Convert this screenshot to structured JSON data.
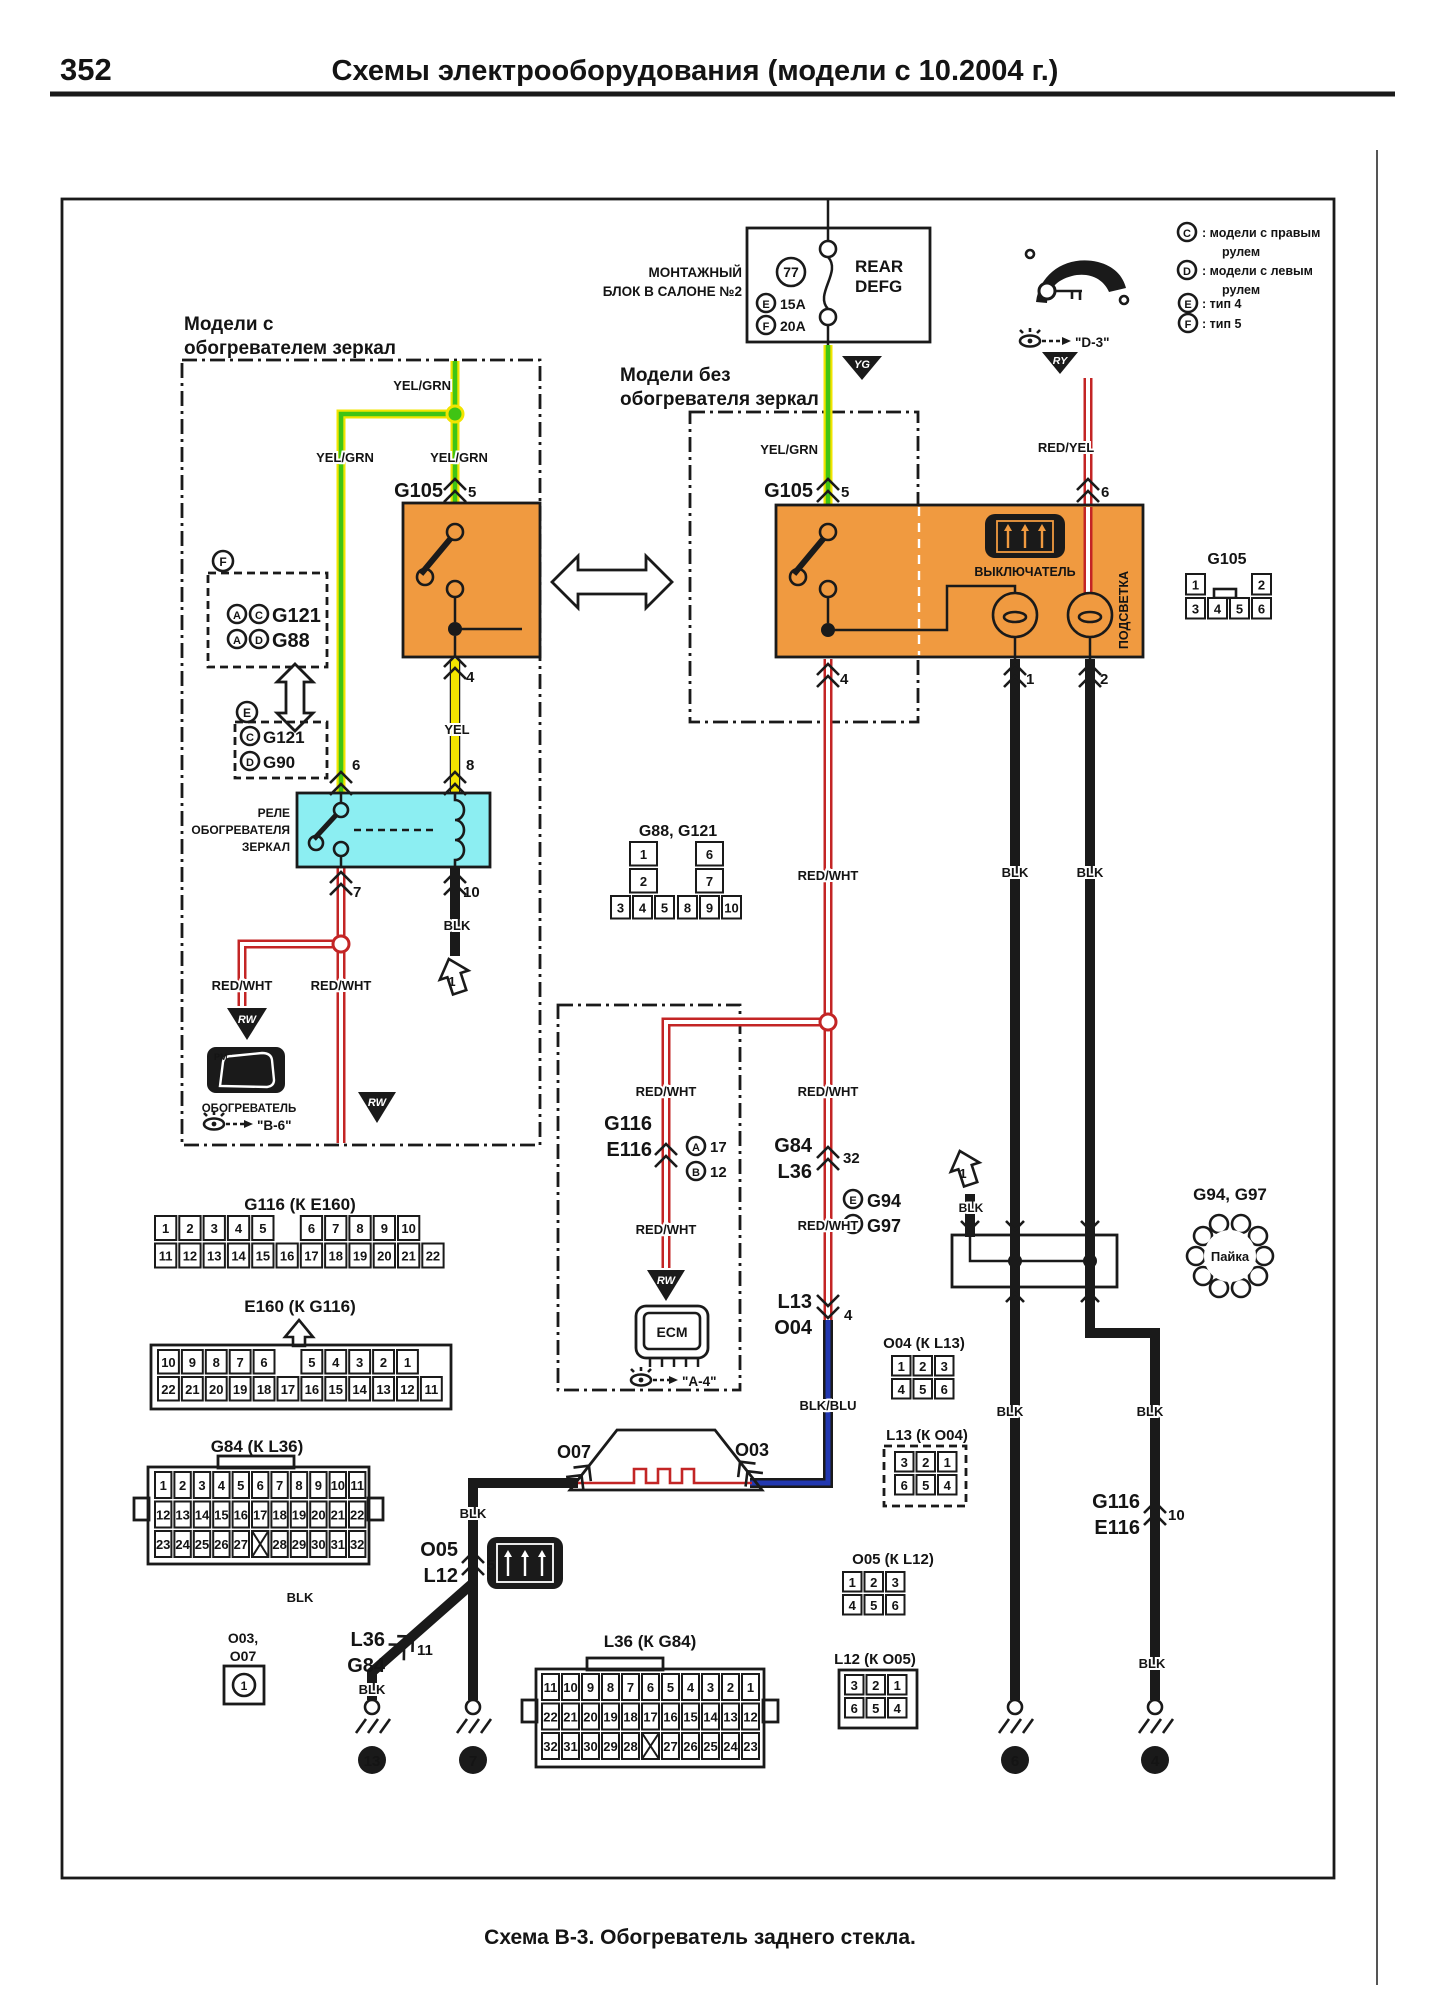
{
  "colors": {
    "orange": "#f09a40",
    "cyan": "#8ceef2",
    "green": "#3fc414",
    "yellow": "#f2e400",
    "red": "#c32525",
    "blue": "#2238b0"
  },
  "page": {
    "number": "352",
    "title": "Схемы электрооборудования (модели с 10.2004 г.)",
    "caption": "Схема В-3. Обогреватель заднего стекла."
  },
  "legend": [
    {
      "sym": "C",
      "l1": ": модели с правым",
      "l2": "рулем"
    },
    {
      "sym": "D",
      "l1": ": модели с левым",
      "l2": "рулем"
    },
    {
      "sym": "E",
      "l1": ": тип 4",
      "l2": ""
    },
    {
      "sym": "F",
      "l1": ": тип 5",
      "l2": ""
    }
  ],
  "fuse": {
    "l1": "МОНТАЖНЫЙ",
    "l2": "БЛОК В САЛОНЕ №2",
    "num": "77",
    "amp_e": "15A",
    "amp_f": "20A",
    "r1": "REAR",
    "r2": "DEFG"
  },
  "flags": {
    "yg": "YG",
    "ry": "RY",
    "rw": "RW"
  },
  "boxes": {
    "with1": "Модели с",
    "with2": "обогревателем зеркал",
    "without1": "Модели без",
    "without2": "обогревателя зеркал"
  },
  "wl": {
    "yelgrn": "YEL/GRN",
    "yel": "YEL",
    "redwht": "RED/WHT",
    "redyel": "RED/YEL",
    "blk": "BLK",
    "blkblu": "BLK/BLU"
  },
  "letters": {
    "a": "A",
    "b": "B",
    "c": "C",
    "d": "D",
    "e": "E",
    "f": "F"
  },
  "names": {
    "g105": "G105",
    "g84": "G84",
    "l36": "L36",
    "g116": "G116",
    "e116": "E116",
    "l13": "L13",
    "o04": "O04",
    "o05": "O05",
    "l12": "L12",
    "o07": "O07",
    "o03": "O03",
    "o03c": "O03,",
    "g94": "G94",
    "g97": "G97",
    "g121": "G121",
    "g88": "G88",
    "g90": "G90",
    "ecm": "ECM"
  },
  "nums": {
    "n1": "1",
    "n2": "2",
    "n4": "4",
    "n5": "5",
    "n6": "6",
    "n7": "7",
    "n8": "8",
    "n10": "10",
    "n11": "11",
    "n12": "12",
    "n13": "13",
    "n17": "17",
    "n32": "32"
  },
  "relay": {
    "l1": "РЕЛЕ",
    "l2": "ОБОГРЕВАТЕЛЯ",
    "l3": "ЗЕРКАЛ"
  },
  "switchbox": {
    "sw": "ВЫКЛЮЧАТЕЛЬ",
    "ill": "ПОДСВЕТКА"
  },
  "mirror": {
    "pm": "PM",
    "lbl": "ОБОГРЕВАТЕЛЬ",
    "ref": "\"В-6\""
  },
  "refs": {
    "d3": "\"D-3\"",
    "a4": "\"А-4\""
  },
  "solder": {
    "title": "G94, G97",
    "lbl": "Пайка"
  },
  "connectors": {
    "g105": {
      "title": "G105",
      "rows": [
        [
          "1",
          null,
          null,
          "2"
        ],
        [
          "3",
          "4",
          "5",
          "6"
        ]
      ]
    },
    "g88_g121": {
      "title": "G88, G121",
      "colA": [
        [
          "1"
        ],
        [
          "2"
        ]
      ],
      "colB": [
        [
          "6"
        ],
        [
          "7"
        ]
      ],
      "rowC": [
        [
          "3",
          "4",
          "5"
        ]
      ],
      "rowD": [
        [
          "8",
          "9",
          "10"
        ]
      ]
    },
    "g116_ke160": {
      "title": "G116 (К Е160)",
      "rows": [
        [
          "1",
          "2",
          "3",
          "4",
          "5",
          null,
          "6",
          "7",
          "8",
          "9",
          "10"
        ],
        [
          "11",
          "12",
          "13",
          "14",
          "15",
          "16",
          "17",
          "18",
          "19",
          "20",
          "21",
          "22"
        ]
      ]
    },
    "e160_kg116": {
      "title": "E160 (К G116)",
      "rows": [
        [
          "10",
          "9",
          "8",
          "7",
          "6",
          null,
          "5",
          "4",
          "3",
          "2",
          "1"
        ],
        [
          "22",
          "21",
          "20",
          "19",
          "18",
          "17",
          "16",
          "15",
          "14",
          "13",
          "12",
          "11"
        ]
      ]
    },
    "g84_kl36": {
      "title": "G84 (К L36)",
      "rows": [
        [
          "1",
          "2",
          "3",
          "4",
          "5",
          "6",
          "7",
          "8",
          "9",
          "10",
          "11"
        ],
        [
          "12",
          "13",
          "14",
          "15",
          "16",
          "17",
          "18",
          "19",
          "20",
          "21",
          "22"
        ],
        [
          "23",
          "24",
          "25",
          "26",
          "27",
          "X",
          "28",
          "29",
          "30",
          "31",
          "32"
        ]
      ]
    },
    "l36_kg84": {
      "title": "L36 (К G84)",
      "rows": [
        [
          "11",
          "10",
          "9",
          "8",
          "7",
          "6",
          "5",
          "4",
          "3",
          "2",
          "1"
        ],
        [
          "22",
          "21",
          "20",
          "19",
          "18",
          "17",
          "16",
          "15",
          "14",
          "13",
          "12"
        ],
        [
          "32",
          "31",
          "30",
          "29",
          "28",
          "X",
          "27",
          "26",
          "25",
          "24",
          "23"
        ]
      ]
    },
    "o04_kl13": {
      "title": "O04 (К L13)",
      "rows": [
        [
          "1",
          "2",
          "3"
        ],
        [
          "4",
          "5",
          "6"
        ]
      ]
    },
    "l13_ko04": {
      "title": "L13 (К O04)",
      "rows": [
        [
          "3",
          "2",
          "1"
        ],
        [
          "6",
          "5",
          "4"
        ]
      ]
    },
    "o05_kl12": {
      "title": "O05 (К L12)",
      "rows": [
        [
          "1",
          "2",
          "3"
        ],
        [
          "4",
          "5",
          "6"
        ]
      ]
    },
    "l12_ko05": {
      "title": "L12 (К O05)",
      "rows": [
        [
          "3",
          "2",
          "1"
        ],
        [
          "6",
          "5",
          "4"
        ]
      ]
    }
  }
}
